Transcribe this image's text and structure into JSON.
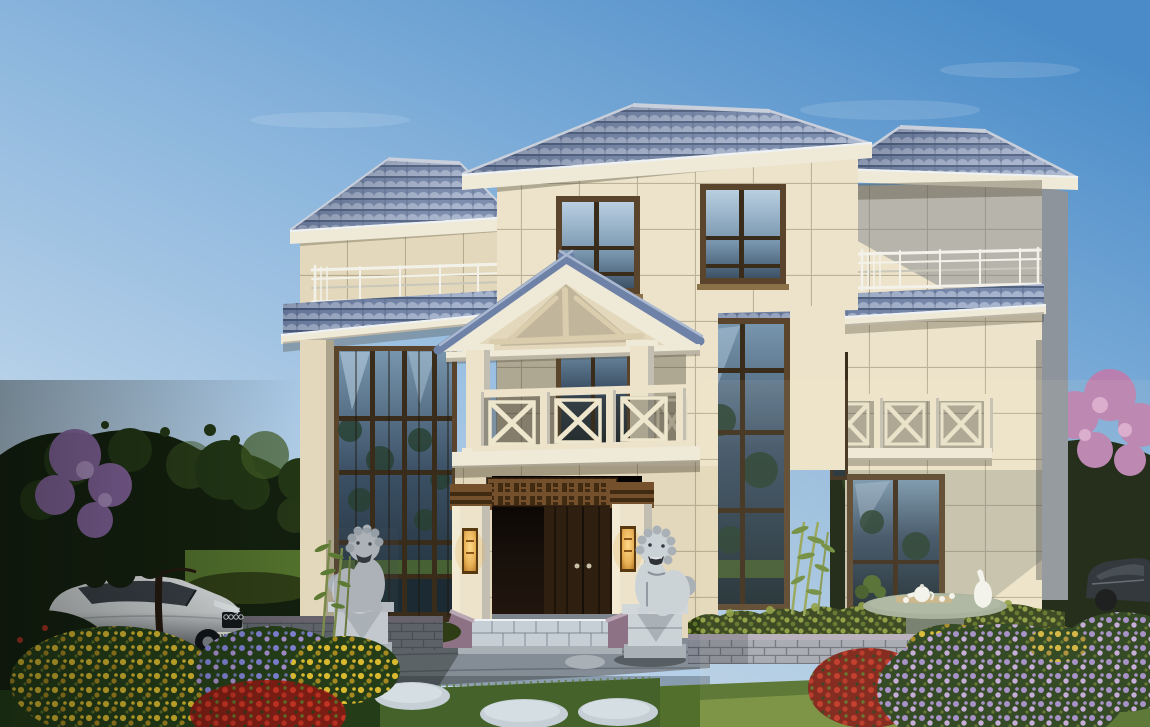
{
  "scene": {
    "type": "architectural-exterior-rendering",
    "subject": "three-story stone villa with blue tiled hip roofs",
    "time_of_day": "day",
    "elements": {
      "sky": "clear blue sky, deeper at top right",
      "house": [
        "main hip roof",
        "right wing tower",
        "left wing with two-story glass curtain wall",
        "porch gable with timber truss",
        "balconies with X-pattern stone railings",
        "terrace railings",
        "blue tile pent roofs",
        "entrance with double wood door",
        "carved lattice frieze",
        "golden wall lanterns",
        "granite step platform"
      ],
      "garden": [
        "stone guardian lion left",
        "stone guardian lion right",
        "clipped hedges",
        "gray brick retaining walls",
        "yellow rose beds",
        "blue aster bed",
        "red flower beds",
        "purple flower beds",
        "bamboo clumps",
        "round stone tea table with tea set and white vase",
        "stepping stones",
        "lawn"
      ],
      "vehicles": [
        "silver sedan at left",
        "dark car at right edge"
      ],
      "trees": [
        "large dark tree left",
        "purple blossom tree left",
        "dark trees right",
        "pink blossom tree right"
      ]
    }
  },
  "palette": {
    "sky_top": "#4b8cc8",
    "sky_mid": "#8fb8de",
    "sky_horizon": "#d6e4f0",
    "cloud": "#ffffff",
    "roof_dark": "#3f5172",
    "roof_mid": "#6e81a6",
    "roof_light": "#aab8d0",
    "roof_ridge": "#c9d0dc",
    "fascia": "#efe9d8",
    "eave_shadow": "#b7ae96",
    "wall_sun": "#ece3ca",
    "wall_warm": "#e3d8bb",
    "wall_shade": "#c2bfb2",
    "wall_gray": "#a9aeb4",
    "wall_dark": "#8e949c",
    "frame_brown": "#5a452c",
    "frame_dark": "#3a2c1a",
    "sill": "#8a7148",
    "glass_sky": "#b9cfe2",
    "glass_mid": "#7795ad",
    "glass_deep": "#3c5166",
    "glass_green": "#27402f",
    "glass_dark": "#1c2b33",
    "rail_white": "#f3f2ea",
    "rail_shade": "#c9c7ba",
    "door_wood": "#2e1f10",
    "door_line": "#17100a",
    "lattice": "#74512c",
    "lattice_dark": "#402a12",
    "lantern_glow": "#e8b054",
    "lantern_mid": "#b37426",
    "lantern_frame": "#59390f",
    "stone_light": "#ccd3d6",
    "stone_mid": "#a9b1b7",
    "stone_dark": "#7d858d",
    "brick": "#a3a8b2",
    "brick_shade": "#8b8f9b",
    "brick_line": "rgba(55,58,70,0.5)",
    "brick_cap": "#b5aebc",
    "brick_purple": "#8d7286",
    "hedge_light": "#8a9c3e",
    "hedge_mid": "#5c6f28",
    "hedge_dark": "#2e3d16",
    "grass_light": "#7c9440",
    "grass_mid": "#52702c",
    "grass_dark": "#243d18",
    "tree_dark": "#131f0e",
    "tree_mid": "#223615",
    "tree_light": "#3e5a22",
    "tree_purple": "#8a67a4",
    "purple_light": "#b393c9",
    "tree_pink": "#b87fb0",
    "pink_light": "#d8a9cf",
    "flower_yellow": "#d9b92f",
    "flower_yellow_dark": "#a8891f",
    "flower_red": "#c03222",
    "flower_red_dark": "#7c1d14",
    "flower_purple": "#a18bc9",
    "flower_lavender": "#c3a9da",
    "flower_blue": "#7e7fd0",
    "paving": "#848d96",
    "paving_light": "#b3bcc2",
    "paving_dark": "#606870",
    "step_stone": "#c6cfd5",
    "step_edge": "#eef2f4",
    "car_silver": "#cfd2d4",
    "car_shadow": "#5a5f63",
    "car_glass": "#2a3138",
    "car_dark_body": "#232a31",
    "table_stone": "#a2ad99",
    "table_dark": "#6f7a6a",
    "porcelain": "#f2f3ef",
    "wood_trunk": "#241810",
    "bamboo": "#8a9a54",
    "bamboo_leaf": "#5d7a34"
  }
}
